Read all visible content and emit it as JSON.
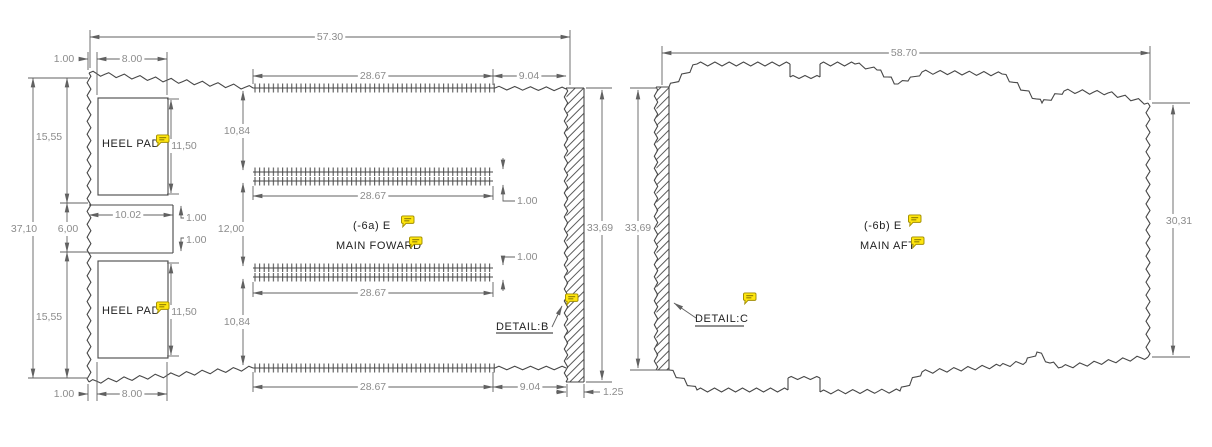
{
  "left_view": {
    "heel_pad_top_label": "HEEL PAD",
    "heel_pad_bottom_label": "HEEL PAD",
    "callout_line1": "(-6a) E",
    "callout_line2": "MAIN FOWARD",
    "detail_label": "DETAIL:B",
    "dims": {
      "overall_width": "57.30",
      "overall_height": "37,10",
      "height_right": "33,69",
      "top_offset": "1.00",
      "bottom_offset": "1.00",
      "heel_pad_width_top": "8.00",
      "heel_pad_width_bottom": "8.00",
      "heel_pad_height_top": "11,50",
      "heel_pad_height_bottom": "11,50",
      "section_height_upper": "15,55",
      "section_height_lower": "15,55",
      "notch_height": "6,00",
      "notch_depth": "10.02",
      "notch_gap_top": "1.00",
      "notch_gap_bottom": "1.00",
      "velcro_length_top": "28.67",
      "velcro_length_mid_upper": "28.67",
      "velcro_length_mid_lower": "28.67",
      "velcro_length_bottom": "28.67",
      "edge_length_top": "9.04",
      "edge_length_bottom": "9.04",
      "velcro_offset_upper": "10,84",
      "velcro_gap_mid": "12,00",
      "velcro_offset_lower": "10,84",
      "strip_thickness_upper": "1.00",
      "strip_thickness_lower": "1.00",
      "detail_strip_width": "1.25"
    }
  },
  "right_view": {
    "callout_line1": "(-6b) E",
    "callout_line2": "MAIN AFT",
    "detail_label": "DETAIL:C",
    "dims": {
      "overall_width": "58.70",
      "height_left": "33,69",
      "height_right": "30,31"
    }
  },
  "annotations": {
    "comment_icon_name": "comment-bubble",
    "comment_icon_count": 8
  },
  "colors": {
    "line": "#474747",
    "dim_line": "#616161",
    "dim_text": "#8c8c8c",
    "label_text": "#1f1f1f",
    "comment_fill": "#ffe60e",
    "comment_stroke": "#a08c00",
    "background": "#ffffff"
  }
}
